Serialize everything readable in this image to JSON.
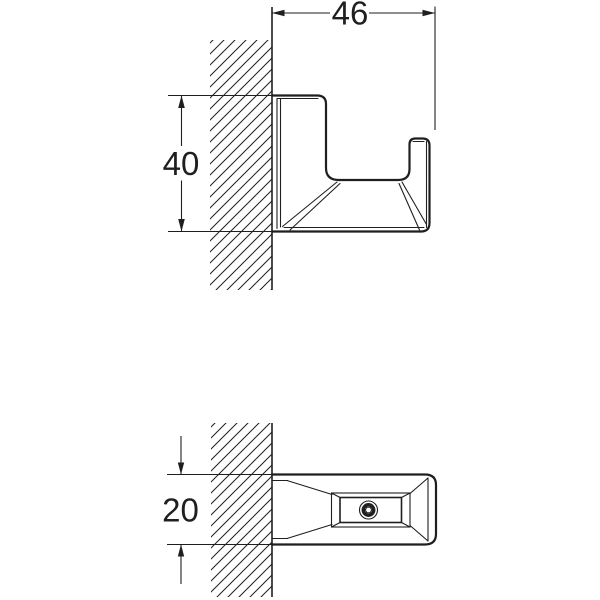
{
  "drawing": {
    "colors": {
      "line": "#1f1f1f",
      "background": "#ffffff"
    },
    "dimensions": {
      "width": "46",
      "height": "40",
      "depth": "20"
    }
  }
}
